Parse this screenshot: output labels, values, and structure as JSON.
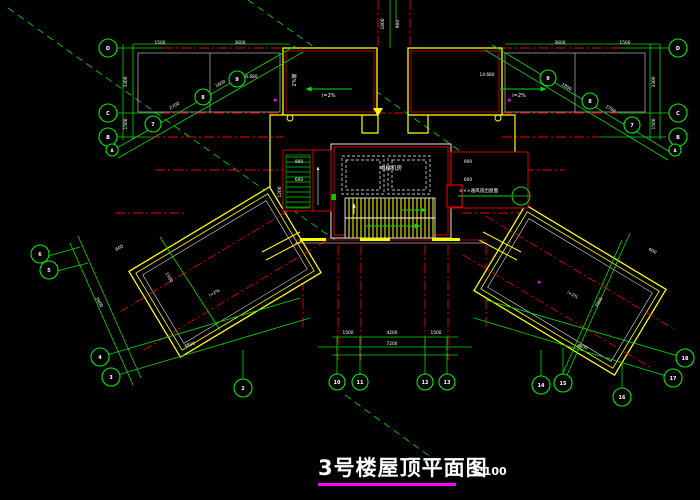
{
  "title": {
    "text": "3号楼屋顶平面图",
    "scale": "1:100",
    "underline_color": "#ff00ff"
  },
  "colors": {
    "background": "#000000",
    "dimension_green": "#00dd00",
    "axis_red": "#ee0000",
    "parapet_yellow": "#ffff00",
    "outline_white": "#ffffff",
    "title_underline": "#ff00ff",
    "drain_magenta": "#ff00ff"
  },
  "annotations": {
    "room_label": "电梯机房",
    "vent_note": "×××通风道出屋面",
    "slope_left": "i=2%",
    "slope_right": "i=2%",
    "slope_top": "2%坡",
    "elev_left": "14.680",
    "elev_right": "14.680"
  },
  "grid_bubbles": [
    {
      "x": 108,
      "y": 48,
      "r": 9,
      "label": "D"
    },
    {
      "x": 108,
      "y": 113,
      "r": 9,
      "label": "C"
    },
    {
      "x": 108,
      "y": 137,
      "r": 9,
      "label": "B"
    },
    {
      "x": 112,
      "y": 150,
      "r": 6,
      "label": "A"
    },
    {
      "x": 678,
      "y": 48,
      "r": 9,
      "label": "D"
    },
    {
      "x": 678,
      "y": 113,
      "r": 9,
      "label": "C"
    },
    {
      "x": 678,
      "y": 137,
      "r": 9,
      "label": "B"
    },
    {
      "x": 675,
      "y": 150,
      "r": 6,
      "label": "A"
    },
    {
      "x": 153,
      "y": 124,
      "r": 8,
      "label": "7"
    },
    {
      "x": 203,
      "y": 97,
      "r": 8,
      "label": "8"
    },
    {
      "x": 237,
      "y": 79,
      "r": 8,
      "label": "9"
    },
    {
      "x": 632,
      "y": 125,
      "r": 8,
      "label": "7"
    },
    {
      "x": 590,
      "y": 101,
      "r": 8,
      "label": "8"
    },
    {
      "x": 548,
      "y": 78,
      "r": 8,
      "label": "9"
    },
    {
      "x": 40,
      "y": 254,
      "r": 9,
      "label": "6"
    },
    {
      "x": 49,
      "y": 270,
      "r": 9,
      "label": "5"
    },
    {
      "x": 100,
      "y": 357,
      "r": 9,
      "label": "4"
    },
    {
      "x": 111,
      "y": 377,
      "r": 9,
      "label": "3"
    },
    {
      "x": 243,
      "y": 388,
      "r": 9,
      "label": "2"
    },
    {
      "x": 337,
      "y": 382,
      "r": 8,
      "label": "10"
    },
    {
      "x": 360,
      "y": 382,
      "r": 8,
      "label": "11"
    },
    {
      "x": 425,
      "y": 382,
      "r": 8,
      "label": "12"
    },
    {
      "x": 447,
      "y": 382,
      "r": 8,
      "label": "13"
    },
    {
      "x": 541,
      "y": 385,
      "r": 9,
      "label": "14"
    },
    {
      "x": 563,
      "y": 383,
      "r": 9,
      "label": "15"
    },
    {
      "x": 622,
      "y": 397,
      "r": 9,
      "label": "16"
    },
    {
      "x": 673,
      "y": 378,
      "r": 9,
      "label": "17"
    },
    {
      "x": 685,
      "y": 358,
      "r": 9,
      "label": "18"
    }
  ],
  "dim_texts": [
    {
      "x": 160,
      "y": 44,
      "rot": 0,
      "text": "1500"
    },
    {
      "x": 240,
      "y": 44,
      "rot": 0,
      "text": "3600"
    },
    {
      "x": 560,
      "y": 44,
      "rot": 0,
      "text": "3600"
    },
    {
      "x": 625,
      "y": 44,
      "rot": 0,
      "text": "1500"
    },
    {
      "x": 127,
      "y": 82,
      "rot": -90,
      "text": "3300"
    },
    {
      "x": 127,
      "y": 124,
      "rot": -90,
      "text": "1500"
    },
    {
      "x": 655,
      "y": 82,
      "rot": -90,
      "text": "3300"
    },
    {
      "x": 655,
      "y": 124,
      "rot": -90,
      "text": "1500"
    },
    {
      "x": 384,
      "y": 24,
      "rot": -90,
      "text": "1800"
    },
    {
      "x": 399,
      "y": 24,
      "rot": -90,
      "text": "900"
    },
    {
      "x": 175,
      "y": 107,
      "rot": -29,
      "text": "2700"
    },
    {
      "x": 221,
      "y": 85,
      "rot": -29,
      "text": "1800"
    },
    {
      "x": 610,
      "y": 110,
      "rot": 29,
      "text": "2700"
    },
    {
      "x": 566,
      "y": 88,
      "rot": 29,
      "text": "1800"
    },
    {
      "x": 98,
      "y": 303,
      "rot": 59,
      "text": "3900"
    },
    {
      "x": 168,
      "y": 278,
      "rot": 59,
      "text": "1500"
    },
    {
      "x": 600,
      "y": 303,
      "rot": -59,
      "text": "3900"
    },
    {
      "x": 190,
      "y": 346,
      "rot": -16,
      "text": "4800"
    },
    {
      "x": 582,
      "y": 348,
      "rot": 16,
      "text": "4800"
    },
    {
      "x": 348,
      "y": 334,
      "rot": 0,
      "text": "1500"
    },
    {
      "x": 392,
      "y": 334,
      "rot": 0,
      "text": "4200"
    },
    {
      "x": 436,
      "y": 334,
      "rot": 0,
      "text": "1500"
    },
    {
      "x": 392,
      "y": 345,
      "rot": 0,
      "text": "7200"
    },
    {
      "x": 299,
      "y": 163,
      "rot": 0,
      "text": "900"
    },
    {
      "x": 299,
      "y": 181,
      "rot": 0,
      "text": "600"
    },
    {
      "x": 281,
      "y": 192,
      "rot": -90,
      "text": "1200"
    },
    {
      "x": 468,
      "y": 163,
      "rot": 0,
      "text": "900"
    },
    {
      "x": 468,
      "y": 181,
      "rot": 0,
      "text": "600"
    },
    {
      "x": 250,
      "y": 78,
      "rot": 0,
      "text": "14.680"
    },
    {
      "x": 487,
      "y": 76,
      "rot": 0,
      "text": "14.680"
    },
    {
      "x": 215,
      "y": 294,
      "rot": -29,
      "text": "i=2%"
    },
    {
      "x": 572,
      "y": 296,
      "rot": 29,
      "text": "i=2%"
    },
    {
      "x": 120,
      "y": 249,
      "rot": -29,
      "text": "600"
    },
    {
      "x": 652,
      "y": 252,
      "rot": 29,
      "text": "600"
    }
  ]
}
